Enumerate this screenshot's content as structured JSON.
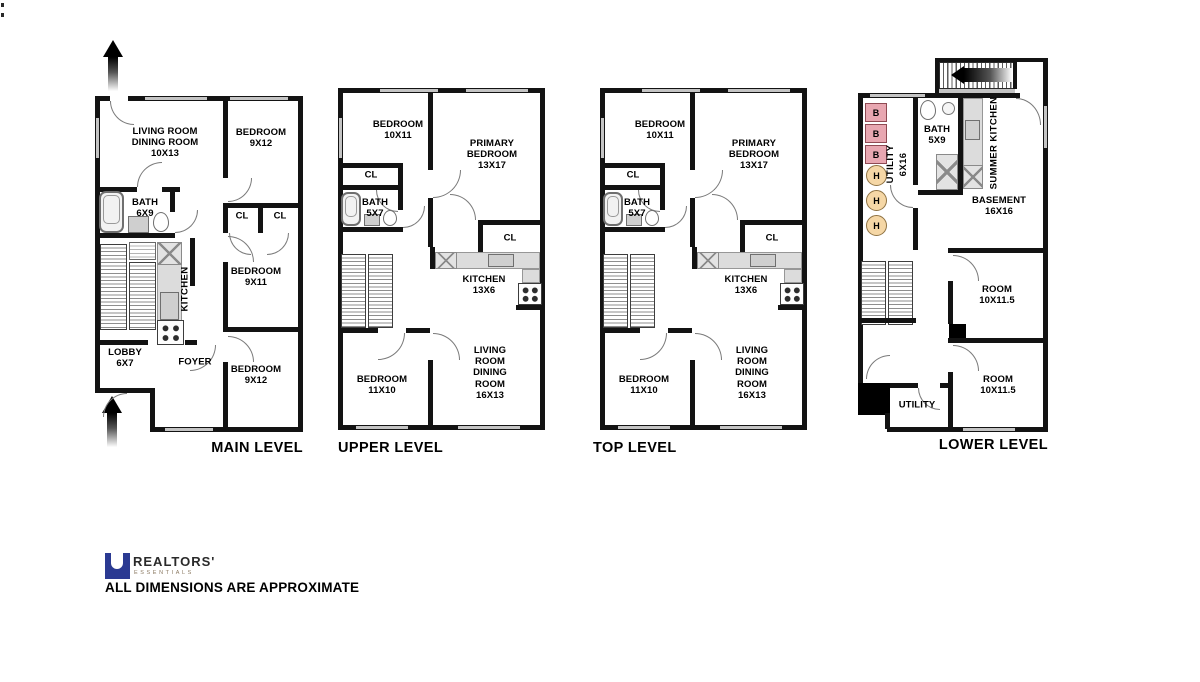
{
  "sheet": {
    "disclaimer": "ALL DIMENSIONS ARE APPROXIMATE",
    "logo": {
      "brand": "REALTORS'",
      "sub": "ESSENTIALS"
    }
  },
  "colors": {
    "wall": "#131313",
    "counter_gray": "#dcdcdc",
    "window_gray": "#c4c4c4",
    "boiler_fill": "#e8a7b1",
    "boiler_border": "#8f4a53",
    "heater_fill": "#f5d7a6",
    "heater_border": "#8f7242",
    "logo_blue": "#2b3a92"
  },
  "plans": {
    "main": {
      "caption": "MAIN LEVEL",
      "rooms": {
        "living": "LIVING ROOM\nDINING ROOM\n10X13",
        "bedroom_front": "BEDROOM\n9X12",
        "bath": "BATH\n6X9",
        "closet_left": "CL",
        "closet_right": "CL",
        "kitchen": "KITCHEN",
        "bedroom_mid": "BEDROOM\n9X11",
        "lobby": "LOBBY\n6X7",
        "foyer": "FOYER",
        "bedroom_rear": "BEDROOM\n9X12"
      }
    },
    "upper": {
      "caption": "UPPER LEVEL",
      "rooms": {
        "bedroom_front": "BEDROOM\n10X11",
        "primary": "PRIMARY\nBEDROOM\n13X17",
        "closet_front": "CL",
        "bath": "BATH\n5X7",
        "closet_primary": "CL",
        "kitchen": "KITCHEN\n13X6",
        "living": "LIVING ROOM\nDINING ROOM\n16X13",
        "bedroom_rear": "BEDROOM\n11X10"
      }
    },
    "top": {
      "caption": "TOP LEVEL",
      "rooms": {
        "bedroom_front": "BEDROOM\n10X11",
        "primary": "PRIMARY\nBEDROOM\n13X17",
        "closet_front": "CL",
        "bath": "BATH\n5X7",
        "closet_primary": "CL",
        "kitchen": "KITCHEN\n13X6",
        "living": "LIVING ROOM\nDINING ROOM\n16X13",
        "bedroom_rear": "BEDROOM\n11X10"
      }
    },
    "lower": {
      "caption": "LOWER LEVEL",
      "rooms": {
        "utility_front": "UTILITY\n6X16",
        "bath": "BATH\n5X9",
        "summer_kitchen": "SUMMER KITCHEN",
        "basement": "BASEMENT\n16X16",
        "room_mid": "ROOM\n10X11.5",
        "room_rear": "ROOM\n10X11.5",
        "utility_rear": "UTILITY"
      },
      "markers": {
        "boiler": "B",
        "heater": "H"
      }
    }
  }
}
